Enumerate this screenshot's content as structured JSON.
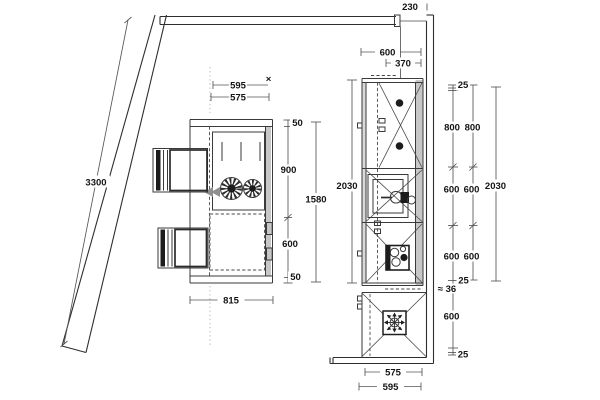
{
  "dimensions": {
    "diagonal_wall": "3300",
    "top_offset": "230",
    "island": {
      "width_top": "595",
      "width_top_inner": "575",
      "end_marker": "×",
      "overhang_top": "50",
      "depth_upper": "900",
      "depth_lower": "600",
      "overhang_bottom": "50",
      "depth_overall": "1580",
      "width_overall": "815"
    },
    "run": {
      "width_top": "600",
      "width_top_inner": "370",
      "length_left": "2030",
      "length_right": "2030",
      "width_bottom_inner": "575",
      "width_bottom_outer": "595"
    },
    "chain_outer": {
      "offset_top": "25",
      "tall_unit": "800",
      "mid_1": "600",
      "mid_2": "600",
      "gap": "≈ 36",
      "lower": "600",
      "offset_bottom": "25"
    },
    "chain_inner": {
      "tall_unit": "800",
      "mid_1": "600",
      "mid_2": "600",
      "offset_bottom": "25"
    }
  }
}
